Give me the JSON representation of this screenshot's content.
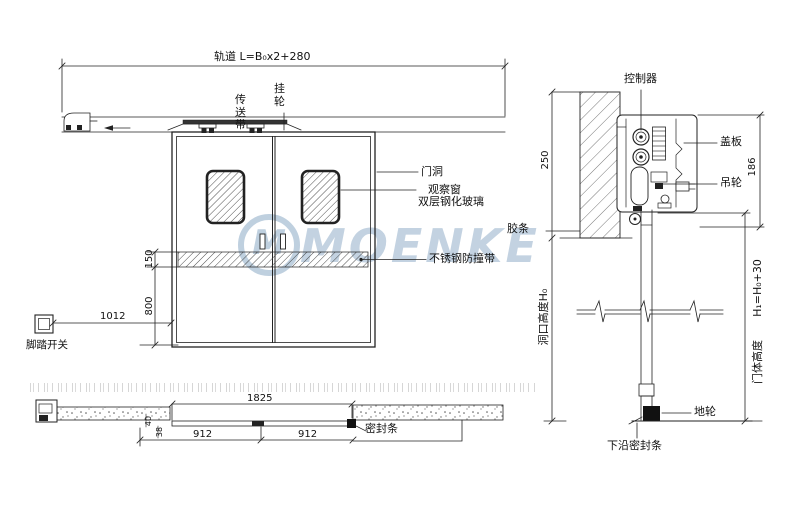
{
  "colors": {
    "line": "#222222",
    "watermark": "#b5c8da"
  },
  "watermark": {
    "logo_letter": "M",
    "brand": "MOENKE"
  },
  "elevation": {
    "track_dim_label": "轨道 L=B₀x2+280",
    "belt_label": "传送带",
    "hanger_label": "挂轮",
    "door_opening_label": "门洞",
    "window_label_line1": "观察窗",
    "window_label_line2": "双层钢化玻璃",
    "bumper_label": "不锈钢防撞带",
    "dim_band_height": "150",
    "dim_below_band": "800",
    "dim_switch_offset": "1012",
    "foot_switch_label": "脚踏开关"
  },
  "section": {
    "controller_label": "控制器",
    "cover_plate_label": "盖板",
    "hanger_wheel_label": "吊轮",
    "rubber_strip_label": "胶条",
    "dim_lintel": "250",
    "dim_header": "186",
    "opening_height_label": "洞口高度H₀",
    "door_height_formula": "H₁=H₀+30",
    "door_height_label": "门体高度",
    "floor_wheel_label": "地轮",
    "bottom_seal_label": "下沿密封条"
  },
  "plan": {
    "dim_total": "1825",
    "dim_left_leaf": "912",
    "dim_right_leaf": "912",
    "dim_leaf_thickness": "40",
    "dim_gap": "38",
    "seal_strip_label": "密封条"
  }
}
